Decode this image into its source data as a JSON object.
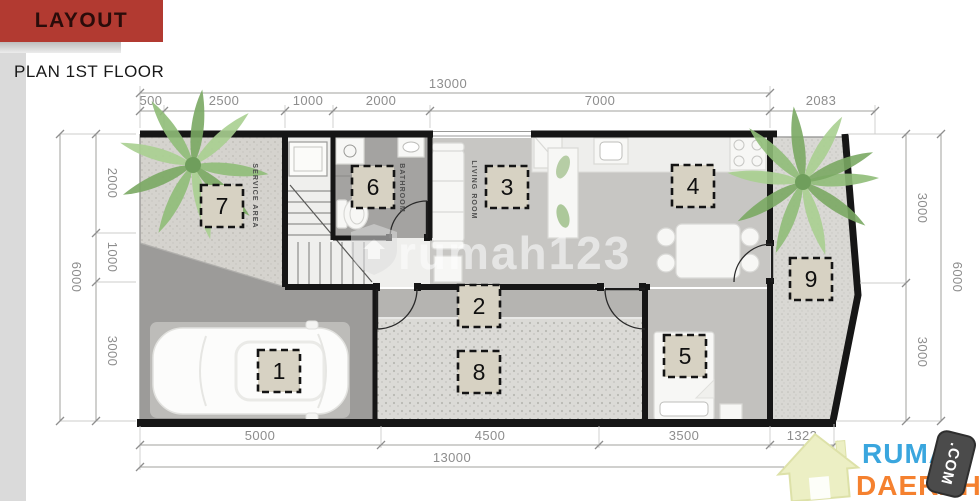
{
  "header": {
    "title": "LAYOUT",
    "subtitle": "PLAN 1ST FLOOR"
  },
  "dimensions": {
    "top": {
      "total": "13000",
      "segments": [
        "500",
        "2500",
        "1000",
        "2000",
        "7000",
        "2083"
      ]
    },
    "bottom": {
      "total": "13000",
      "segments": [
        "5000",
        "4500",
        "3500",
        "1322"
      ]
    },
    "left": {
      "total": "6000",
      "segments": [
        "2000",
        "1000",
        "3000"
      ]
    },
    "right": {
      "total": "6000",
      "segments": [
        "3000",
        "3000"
      ]
    }
  },
  "plan": {
    "rooms": [
      {
        "number": "1"
      },
      {
        "number": "2"
      },
      {
        "number": "3"
      },
      {
        "number": "4"
      },
      {
        "number": "5"
      },
      {
        "number": "6"
      },
      {
        "number": "7"
      },
      {
        "number": "8"
      },
      {
        "number": "9"
      }
    ],
    "area_labels": {
      "service": "SERVICE AREA",
      "bathroom": "BATHROOM",
      "living": "LIVING ROOM"
    }
  },
  "watermark": {
    "text": "rumah123"
  },
  "logo": {
    "top": "RUMAH",
    "bottom": "DAERAH",
    "badge": ".COM"
  },
  "colors": {
    "banner": "#b23a31",
    "logo_blue": "#3aa6de",
    "logo_orange": "#f5812f",
    "wall": "#161616"
  }
}
